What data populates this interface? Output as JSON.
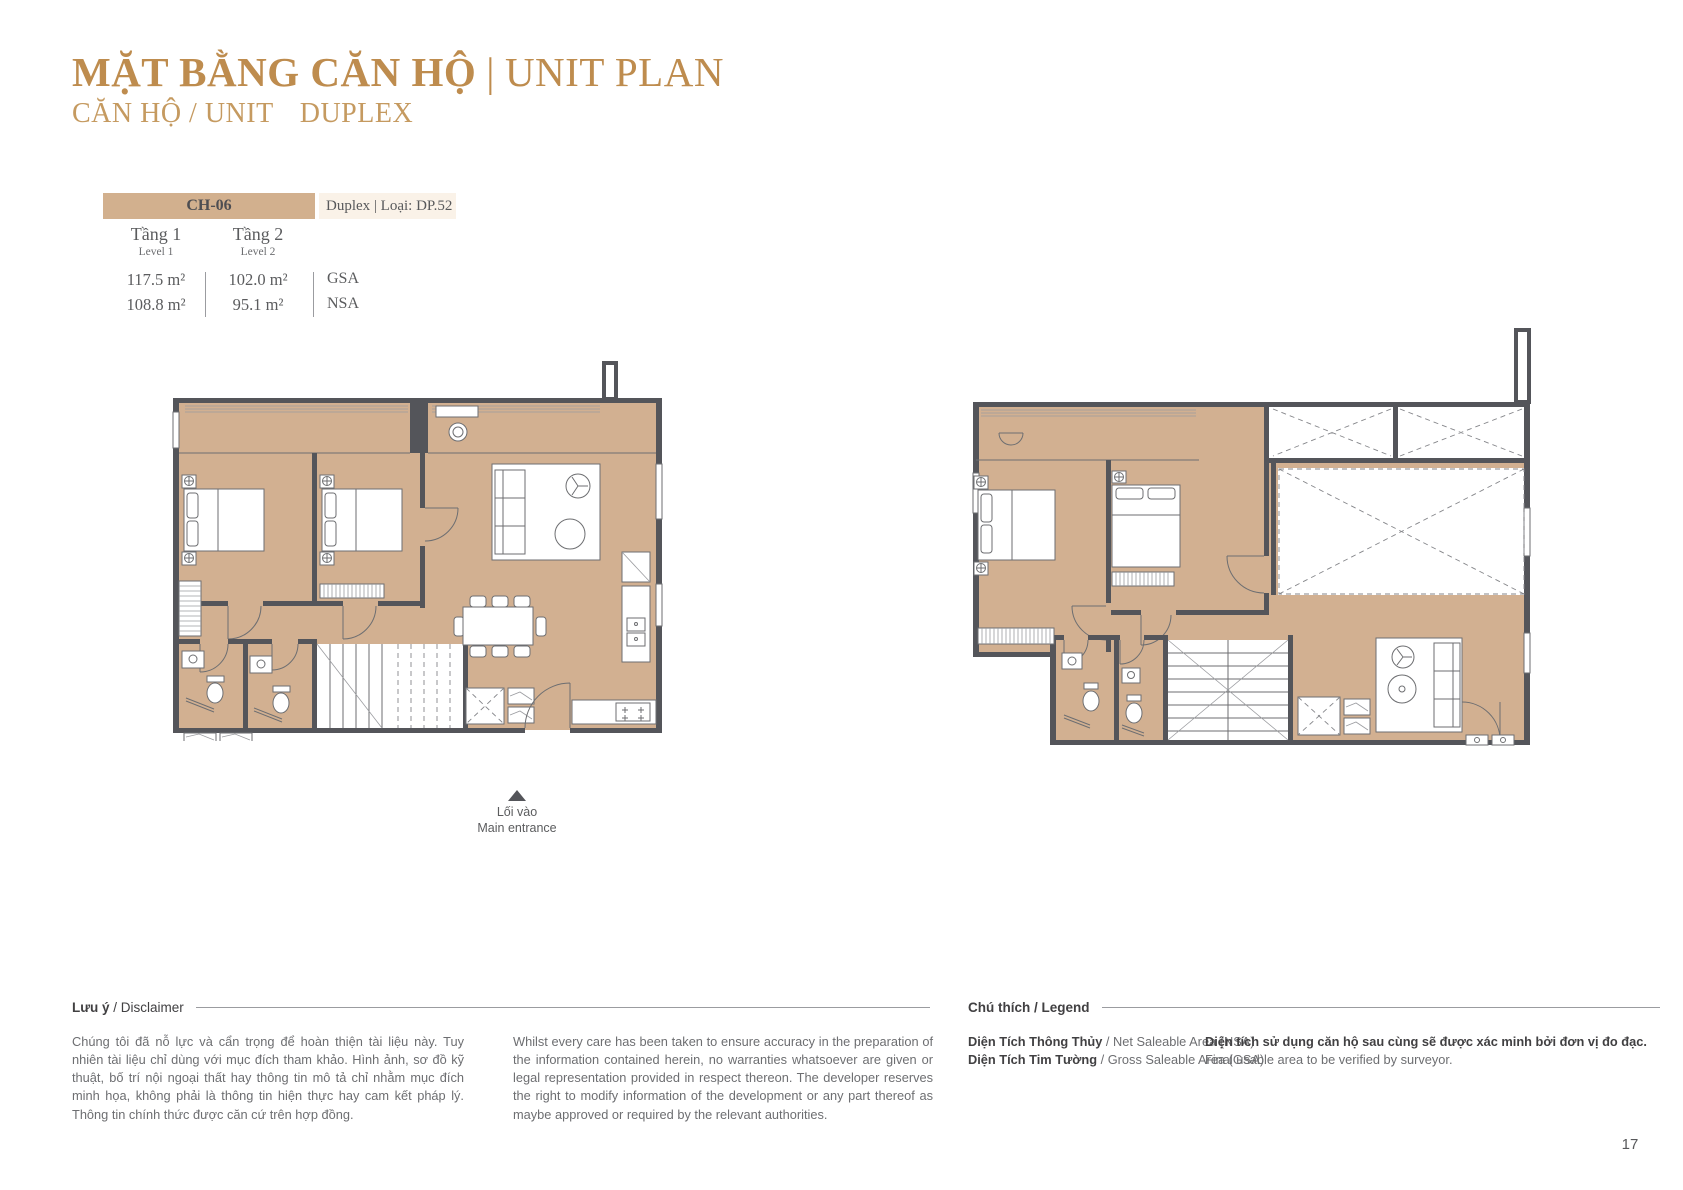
{
  "header": {
    "title_vi": "MẶT BẰNG CĂN HỘ",
    "title_sep": "|",
    "title_en": "UNIT PLAN",
    "subtitle_label": "CĂN HỘ / UNIT",
    "subtitle_value": "DUPLEX"
  },
  "unit_table": {
    "unit_code": "CH-06",
    "unit_type": "Duplex | Loại: DP.52",
    "columns": [
      {
        "level_vi": "Tầng 1",
        "level_en": "Level 1",
        "gsa": "117.5 m²",
        "nsa": "108.8 m²"
      },
      {
        "level_vi": "Tầng 2",
        "level_en": "Level 2",
        "gsa": "102.0 m²",
        "nsa": "95.1 m²"
      }
    ],
    "gsa_label": "GSA",
    "nsa_label": "NSA"
  },
  "entrance": {
    "label_vi": "Lối vào",
    "label_en": "Main entrance"
  },
  "disclaimer": {
    "heading_bold": "Lưu ý",
    "heading_rest": " / Disclaimer",
    "text_vi": "Chúng tôi đã nỗ lực và cẩn trọng để hoàn thiện tài liệu này. Tuy nhiên tài liệu chỉ dùng với mục đích tham khảo. Hình ảnh, sơ đồ kỹ thuật, bố trí nội ngoại thất hay thông tin mô tả chỉ nhằm mục đích minh họa, không phải là thông tin hiện thực hay cam kết pháp lý. Thông tin chính thức được căn cứ trên hợp đồng.",
    "text_en": "Whilst every care has been taken to ensure accuracy in the preparation of the information contained herein, no warranties whatsoever are given or legal representation provided in respect thereon. The developer reserves the right to modify information of the development or any part thereof as maybe approved or required by the relevant authorities."
  },
  "legend": {
    "heading": "Chú thích / Legend",
    "items": [
      {
        "bold": "Diện Tích Thông Thủy",
        "rest": " / Net Saleable Area (NSA)"
      },
      {
        "bold": "Diện Tích Tim Tường",
        "rest": " / Gross Saleable Area (GSA)"
      }
    ],
    "note_bold": "Diện tích sử dụng căn hộ sau cùng sẽ được xác minh bởi đơn vị đo đạc.",
    "note_rest": "Final usable area to be verified by surveyor."
  },
  "page_number": "17",
  "colors": {
    "accent_gold": "#BE8C4E",
    "accent_gold_light": "#C59A60",
    "floor_tan": "#D2B091",
    "table_bar_tan": "#D2B08E",
    "cream": "#FAF2E8",
    "wall_gray": "#54555A",
    "text_gray": "#5B5C5E",
    "muted_gray": "#6D6E71"
  }
}
